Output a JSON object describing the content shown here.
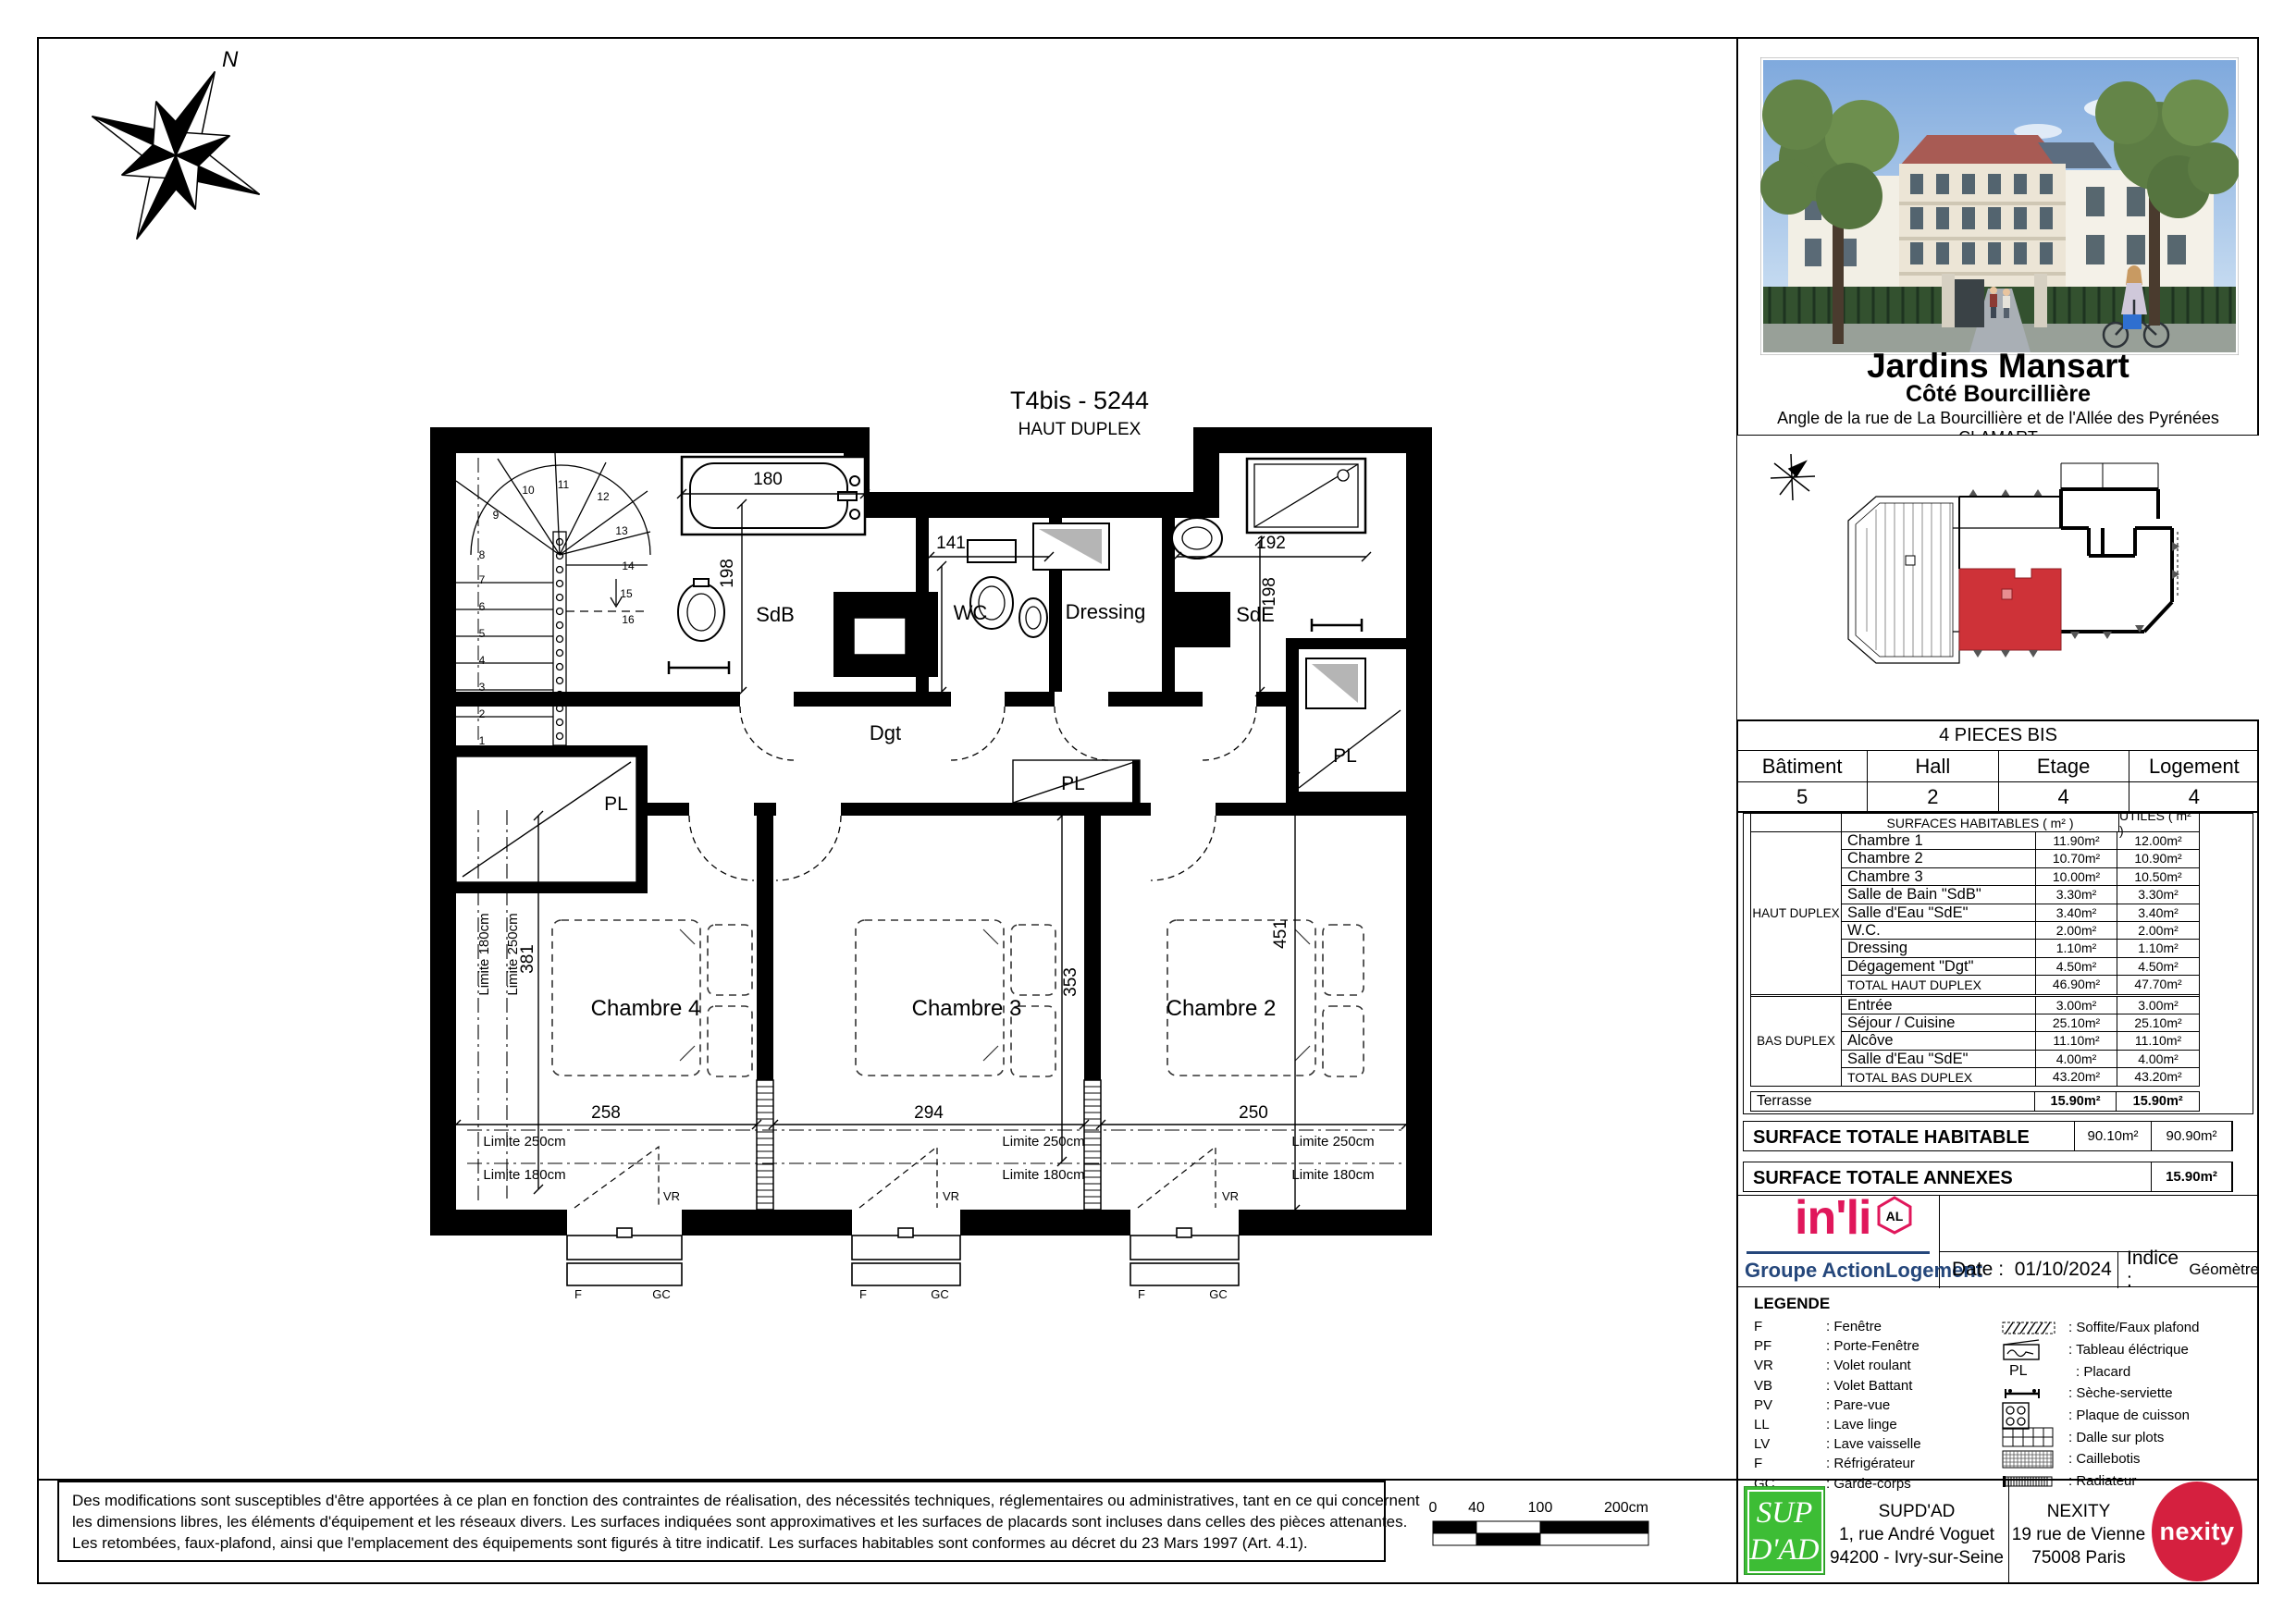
{
  "colors": {
    "unit_red": "#CE3238",
    "inli_pink": "#E0175B",
    "action_blue": "#25477B",
    "supdad_green": "#3DBD35",
    "nexity_red": "#D5203F"
  },
  "plan": {
    "title": "T4bis - 5244",
    "subtitle": "HAUT DUPLEX",
    "north": "N",
    "rooms": {
      "sdb": "SdB",
      "wc": "WC",
      "dressing": "Dressing",
      "sde": "SdE",
      "dgt": "Dgt",
      "ch4": "Chambre 4",
      "ch3": "Chambre 3",
      "ch2": "Chambre 2",
      "pl": "PL"
    },
    "dims": {
      "tub": "180",
      "sdb_h": "198",
      "wc_w": "141",
      "wc_h": "148",
      "sde_w": "192",
      "sde_h": "198",
      "ch4_w": "258",
      "ch3_w": "294",
      "ch2_w": "250",
      "ch4_h": "381",
      "ch3_h": "353",
      "ch2_h": "451"
    },
    "limits": {
      "l180": "Limite 180cm",
      "l250": "Limite 250cm"
    },
    "win": {
      "f": "F",
      "gc": "GC",
      "vr": "VR"
    },
    "stair_numbers": [
      "1",
      "2",
      "3",
      "4",
      "5",
      "6",
      "7",
      "8",
      "9",
      "10",
      "11",
      "12",
      "13",
      "14",
      "15",
      "16"
    ]
  },
  "sidebar": {
    "project": {
      "name": "Jardins Mansart",
      "subtitle": "Côté Bourcillière",
      "address": "Angle de la rue de La Bourcillière et de l'Allée des Pyrénées",
      "city": "CLAMART"
    },
    "type_header": "4 PIECES BIS",
    "unit_table": {
      "headers": [
        "Bâtiment",
        "Hall",
        "Etage",
        "Logement"
      ],
      "values": [
        "5",
        "2",
        "4",
        "4"
      ]
    },
    "surfaces": {
      "col_headers": [
        "SURFACES HABITABLES ( m² )",
        "UTILES ( m² )"
      ],
      "groups": [
        {
          "label": "HAUT DUPLEX",
          "rows": [
            [
              "Chambre 1",
              "11.90m²",
              "12.00m²"
            ],
            [
              "Chambre 2",
              "10.70m²",
              "10.90m²"
            ],
            [
              "Chambre 3",
              "10.00m²",
              "10.50m²"
            ],
            [
              "Salle de Bain \"SdB\"",
              "3.30m²",
              "3.30m²"
            ],
            [
              "Salle d'Eau \"SdE\"",
              "3.40m²",
              "3.40m²"
            ],
            [
              "W.C.",
              "2.00m²",
              "2.00m²"
            ],
            [
              "Dressing",
              "1.10m²",
              "1.10m²"
            ],
            [
              "Dégagement \"Dgt\"",
              "4.50m²",
              "4.50m²"
            ],
            [
              "TOTAL HAUT DUPLEX",
              "46.90m²",
              "47.70m²"
            ]
          ]
        },
        {
          "label": "BAS DUPLEX",
          "rows": [
            [
              "Entrée",
              "3.00m²",
              "3.00m²"
            ],
            [
              "Séjour / Cuisine",
              "25.10m²",
              "25.10m²"
            ],
            [
              "Alcôve",
              "11.10m²",
              "11.10m²"
            ],
            [
              "Salle d'Eau \"SdE\"",
              "4.00m²",
              "4.00m²"
            ],
            [
              "TOTAL BAS DUPLEX",
              "43.20m²",
              "43.20m²"
            ]
          ]
        }
      ],
      "terrasse": {
        "label": "Terrasse",
        "v1": "15.90m²",
        "v2": "15.90m²"
      },
      "total_habitable": {
        "label": "SURFACE TOTALE HABITABLE",
        "v1": "90.10m²",
        "v2": "90.90m²"
      },
      "total_annexes": {
        "label": "SURFACE TOTALE ANNEXES",
        "v": "15.90m²"
      }
    },
    "brand": {
      "inli": "in'li",
      "al": "AL",
      "groupe": "Groupe ActionLogement",
      "date_label": "Date :",
      "date": "01/10/2024",
      "indice_label": "Indice :",
      "indice": "Géomètre"
    },
    "legend": {
      "title": "LEGENDE",
      "abbr": [
        [
          "F",
          "Fenêtre"
        ],
        [
          "PF",
          "Porte-Fenêtre"
        ],
        [
          "VR",
          "Volet roulant"
        ],
        [
          "VB",
          "Volet Battant"
        ],
        [
          "PV",
          "Pare-vue"
        ],
        [
          "LL",
          "Lave linge"
        ],
        [
          "LV",
          "Lave vaisselle"
        ],
        [
          "F",
          "Réfrigérateur"
        ],
        [
          "GC",
          "Garde-corps"
        ]
      ],
      "symbols": [
        {
          "kind": "soffite",
          "label": "Soffite/Faux plafond"
        },
        {
          "kind": "tableau",
          "label": "Tableau éléctrique"
        },
        {
          "kind": "placard",
          "sym": "PL",
          "label": "Placard"
        },
        {
          "kind": "seche",
          "label": "Sèche-serviette"
        },
        {
          "kind": "plaque",
          "label": "Plaque de cuisson"
        },
        {
          "kind": "dalle",
          "label": "Dalle sur plots"
        },
        {
          "kind": "caillebotis",
          "label": "Caillebotis"
        },
        {
          "kind": "radiateur",
          "label": "Radiateur"
        }
      ]
    }
  },
  "footer": {
    "disclaimer_lines": [
      "Des modifications sont susceptibles d'être apportées à ce plan en fonction des contraintes de réalisation, des nécessités techniques, réglementaires ou administratives, tant en ce qui concernent",
      "les dimensions libres, les éléments d'équipement et les réseaux divers. Les surfaces indiquées sont approximatives et les surfaces de placards sont incluses dans celles des pièces attenantes.",
      "Les retombées, faux-plafond, ainsi que l'emplacement des équipements sont figurés à titre indicatif. Les surfaces habitables sont conformes au décret du 23 Mars 1997 (Art. 4.1)."
    ],
    "scale": {
      "ticks": [
        "0",
        "40",
        "100",
        "200cm"
      ]
    },
    "supdad_logo": {
      "line1": "SUP",
      "line2": "D'AD"
    },
    "supdad": {
      "name": "SUPD'AD",
      "addr1": "1, rue André Voguet",
      "addr2": "94200 - Ivry-sur-Seine"
    },
    "nexity": {
      "name": "NEXITY",
      "addr1": "19 rue de Vienne",
      "addr2": "75008 Paris"
    },
    "nexity_logo": "nexity"
  }
}
